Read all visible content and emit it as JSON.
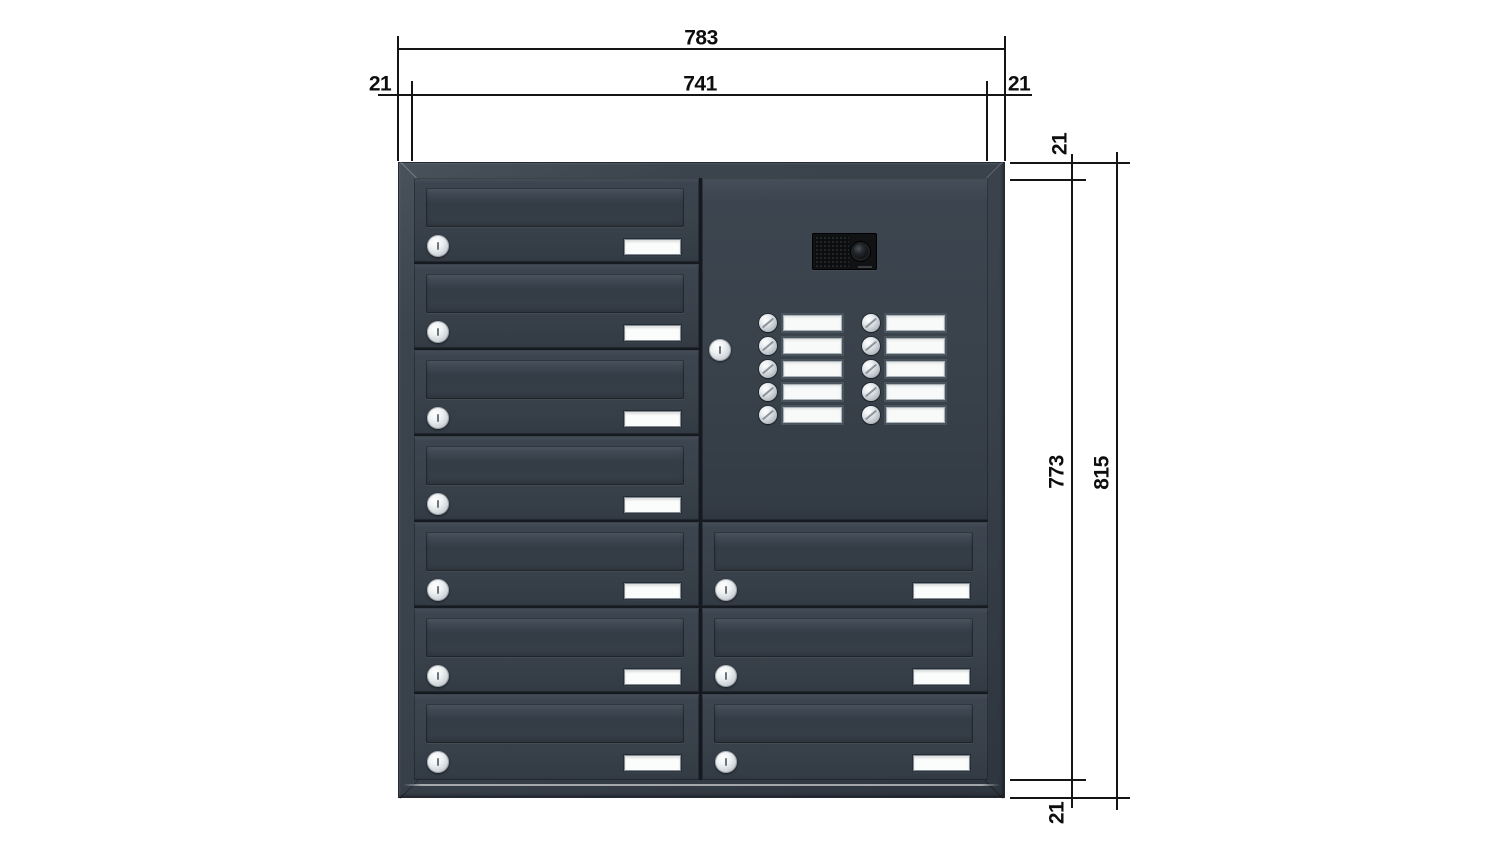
{
  "drawing": {
    "title": "Letterbox bank with intercom — dimension drawing",
    "background_color": "#ffffff",
    "line_color": "#151515",
    "dimensions": {
      "width_outer": "783",
      "width_inner": "741",
      "margin_left": "21",
      "margin_right": "21",
      "margin_top": "21",
      "height_inner": "773",
      "height_outer": "815",
      "margin_bottom": "21"
    },
    "cabinet": {
      "body_color": "#39414b",
      "frame_edge_color": "#232930",
      "gap_color": "#141a1f",
      "lock_color": "#e8ebee",
      "name_plate_color": "#fbfcfc",
      "left_column": {
        "mailboxes": 7
      },
      "right_column": {
        "mailboxes": 3,
        "intercom_panel": {
          "camera_modules": 1,
          "locks": 1,
          "bell_button_columns": 2,
          "bell_buttons_per_column": 5,
          "bell_buttons_total": 10
        }
      }
    }
  }
}
